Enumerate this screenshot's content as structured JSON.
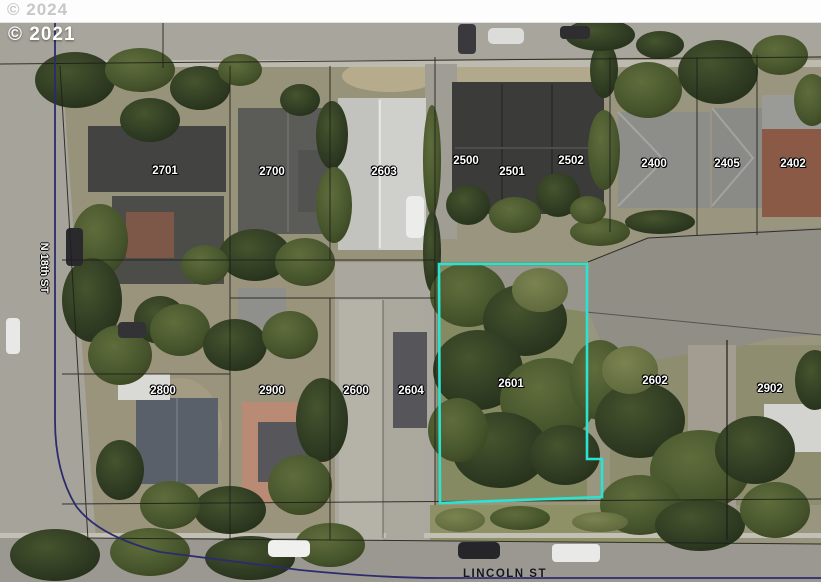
{
  "attribution": {
    "outer_year": "© 2024",
    "photo_year": "© 2021"
  },
  "streets": {
    "left_vertical": "N 18th ST",
    "bottom": "LINCOLN ST"
  },
  "parcels": [
    {
      "id": "2701",
      "x": 165,
      "y": 171
    },
    {
      "id": "2700",
      "x": 272,
      "y": 172
    },
    {
      "id": "2603",
      "x": 384,
      "y": 172
    },
    {
      "id": "2500",
      "x": 466,
      "y": 161
    },
    {
      "id": "2501",
      "x": 512,
      "y": 172
    },
    {
      "id": "2502",
      "x": 571,
      "y": 161
    },
    {
      "id": "2400",
      "x": 654,
      "y": 164
    },
    {
      "id": "2405",
      "x": 727,
      "y": 164
    },
    {
      "id": "2402",
      "x": 793,
      "y": 164
    },
    {
      "id": "2800",
      "x": 163,
      "y": 391
    },
    {
      "id": "2900",
      "x": 272,
      "y": 391
    },
    {
      "id": "2600",
      "x": 356,
      "y": 391
    },
    {
      "id": "2604",
      "x": 411,
      "y": 391
    },
    {
      "id": "2601",
      "x": 511,
      "y": 384
    },
    {
      "id": "2602",
      "x": 655,
      "y": 381
    },
    {
      "id": "2902",
      "x": 770,
      "y": 389
    }
  ],
  "highlighted_parcel": {
    "id": "2601",
    "outline_color": "#2be3d3"
  },
  "colors": {
    "road_gray": "#a7a49b",
    "boundary_blue": "#2b2b6e",
    "parcel_line": "#1d1d1a"
  }
}
